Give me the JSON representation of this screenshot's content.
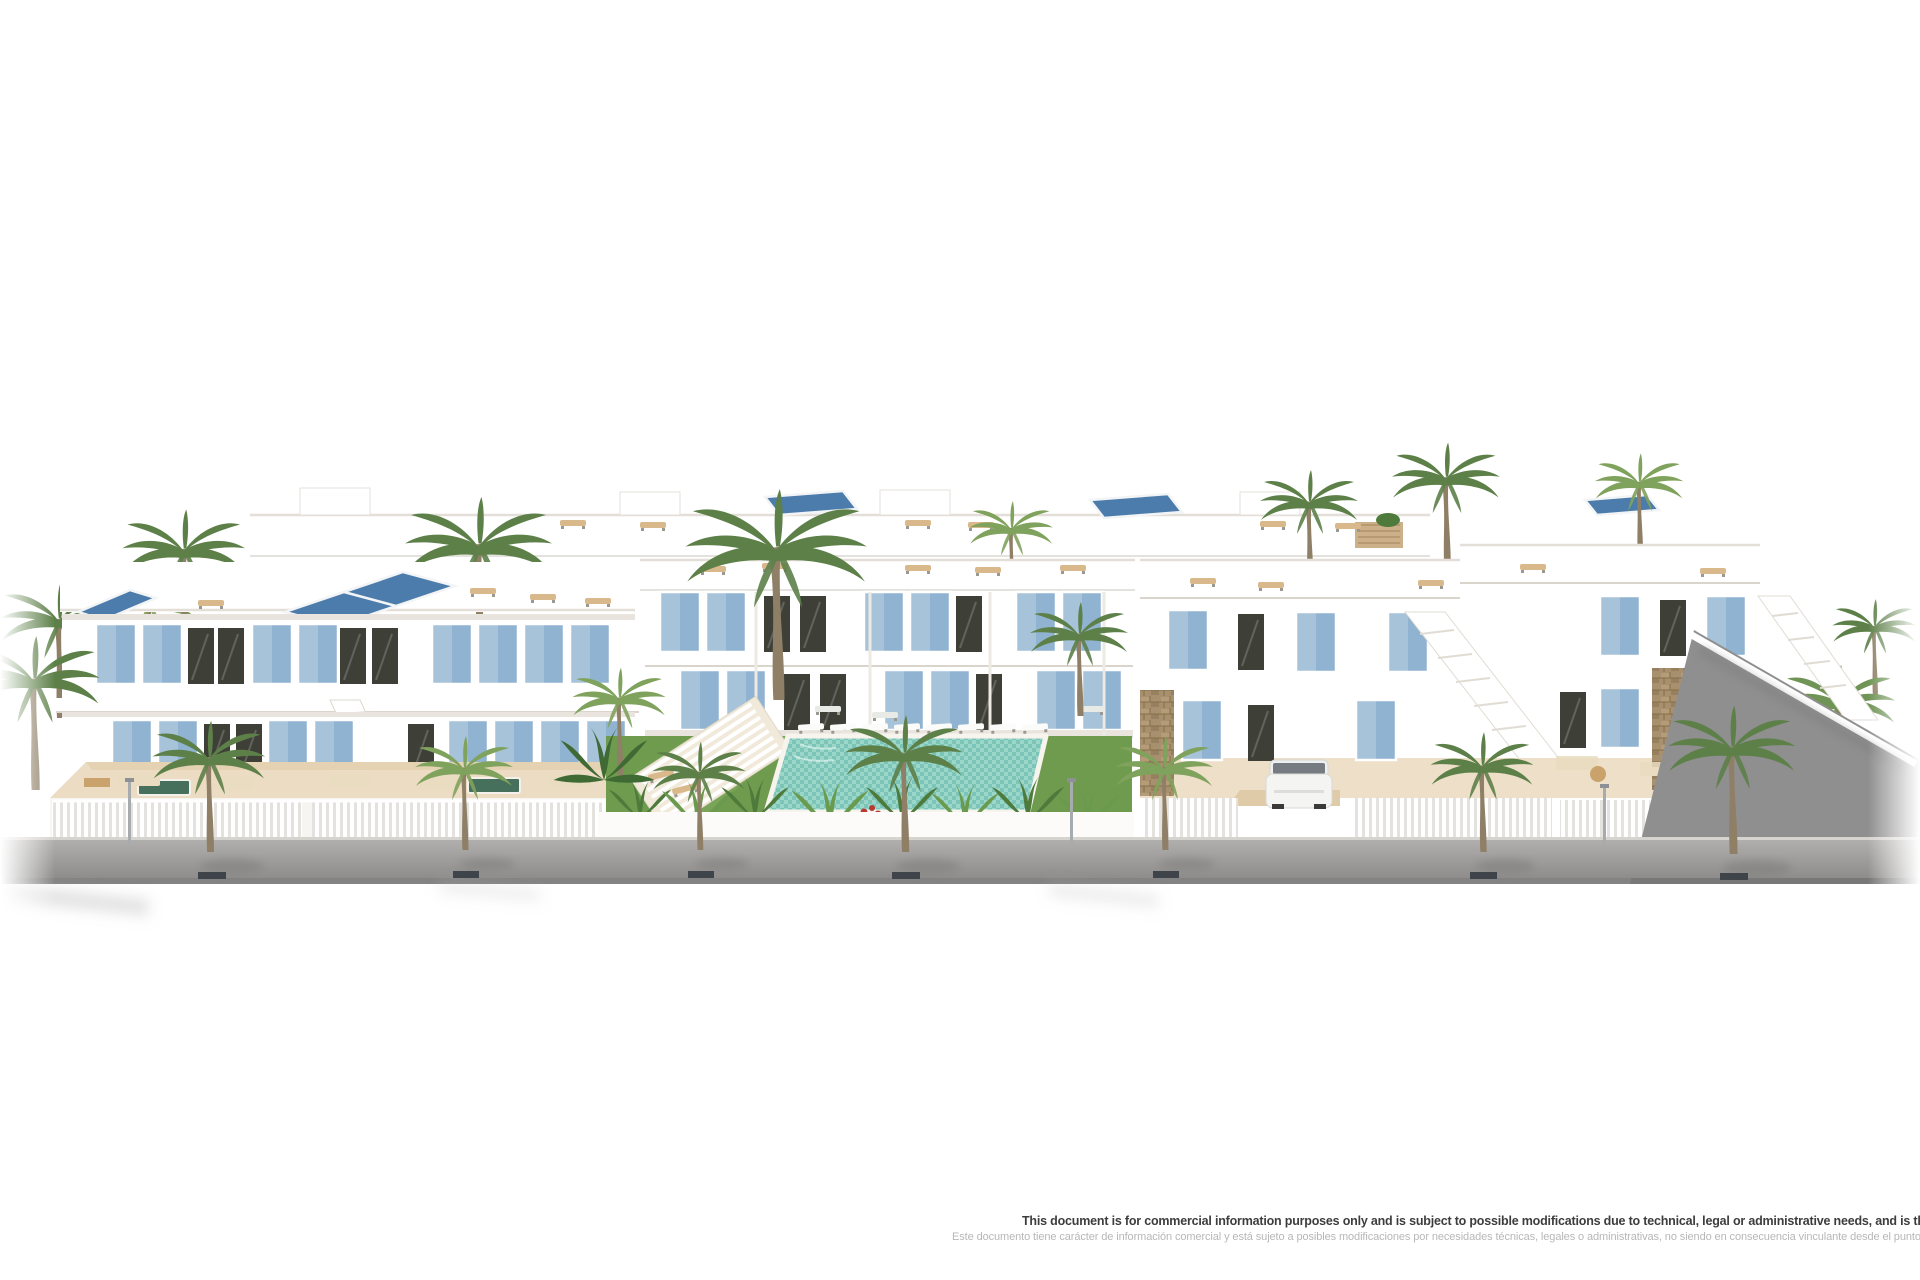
{
  "image": {
    "kind": "3d-architectural-render",
    "subject": "White Mediterranean-style residential development with roof terraces, solar panels, light-blue shutters, palm trees, communal lawn and tiled swimming pool, fronted by a grey street with sidewalk palms"
  },
  "palette": {
    "bg": "#ffffff",
    "facadeShadow": "#e9e5de",
    "terraceFloor": "#ecdcc3",
    "terraceFloorDark": "#e0cba9",
    "blueShutter": "#a6c3da",
    "blueShutterDark": "#8fb3d0",
    "solarPanel": "#4c7cab",
    "glassDark": "#3e4038",
    "grass": "#6f9b4e",
    "grassLight": "#86ad60",
    "palmFrond": "#5d8049",
    "palmFrondLight": "#7fa25c",
    "palmTrunk": "#8f7f66",
    "poolWater": "#7cc4b8",
    "poolWaterLight": "#9ad7c9",
    "roadTop": "#b0afad",
    "roadBottom": "#8e8d8b",
    "curb": "#d6d4cf",
    "roadEdge": "#767676",
    "rampGray": "#8f8f8f",
    "stone": "#a8906e",
    "stoneDark": "#857049",
    "furnitureCream": "#e9dcc0",
    "furnitureTan": "#d3b183",
    "grate": "#3f444a",
    "textPrimary": "#3d3d3d",
    "textSecondary": "#b7b7b7"
  },
  "disclaimer": {
    "line_en": "This document is for commercial information purposes only and is subject to possible modifications due to technical, legal or administrative needs, and is therefore not binding",
    "line_es": "Este documento tiene carácter de información comercial y está sujeto a posibles modificaciones por necesidades técnicas, legales o administrativas, no siendo en consecuencia vinculante desde el punto"
  }
}
